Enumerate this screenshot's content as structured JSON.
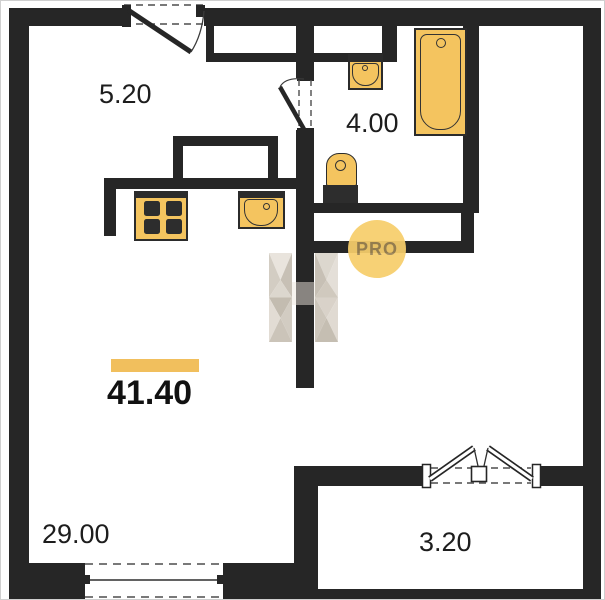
{
  "watermark": {
    "badge_text": "PRO"
  },
  "total_area": {
    "value": "41.40"
  },
  "rooms": {
    "hall": {
      "area_label": "5.20"
    },
    "bathroom": {
      "area_label": "4.00"
    },
    "living": {
      "area_label": "29.00"
    },
    "balcony": {
      "area_label": "3.20"
    }
  },
  "colors": {
    "wall": "#262626",
    "fixture_fill": "#F4C45F",
    "fixture_stroke": "#2B2B2B",
    "accent_bar": "#F1BF5D",
    "badge_fill": "#F7CE6B",
    "badge_text": "#9C8352",
    "logo_light": "#E7E2DA",
    "logo_mid": "#D2CBC1",
    "logo_dark": "#BEB5A9",
    "dash_line": "#4D4D4D"
  }
}
